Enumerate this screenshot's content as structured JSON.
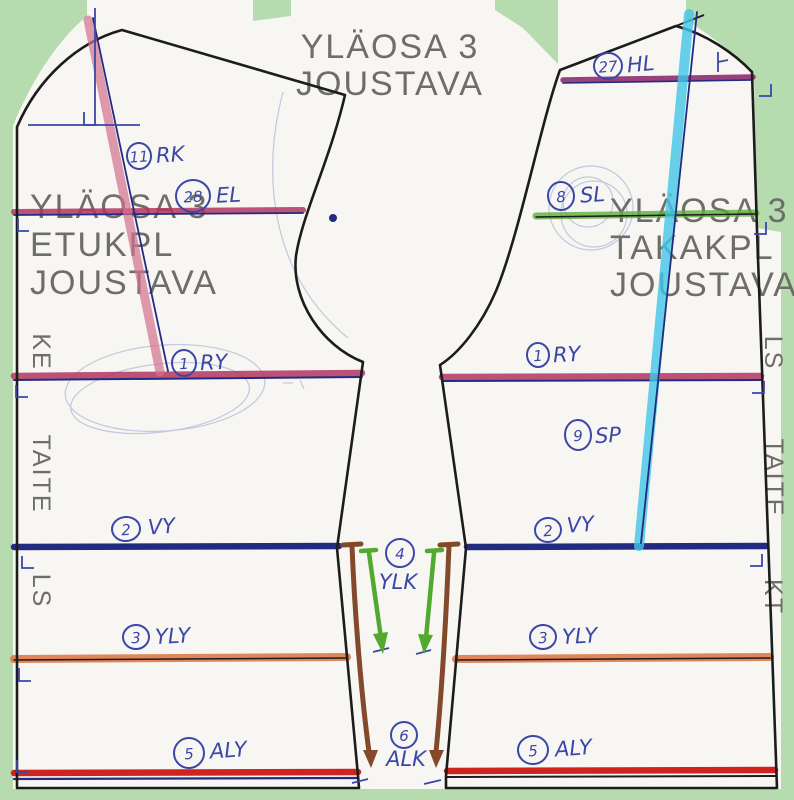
{
  "colors": {
    "background": "#b6dbaf",
    "paper": "#f7f6f2",
    "outline": "#1c1c1c",
    "printed_gray": "#6e6d6a",
    "pen_blue": "#3a47a7",
    "navy": "#232b80",
    "crimson": "#b23560",
    "purple_hl": "#8d2e72",
    "orange": "#dd7340",
    "red": "#cf231f",
    "green_line": "#5fae3e",
    "cyan": "#41c6e8",
    "pink": "#d2718f",
    "brown": "#83492a",
    "arrow_green": "#52a930",
    "pencil": "#98a2cf"
  },
  "header": {
    "title_line1": "YLÄOSA 3",
    "title_line2": "JOUSTAVA"
  },
  "front_piece": {
    "lines": [
      "YLÄOSA 3",
      "ETUKPL",
      "JOUSTAVA"
    ],
    "edge_top": "KE",
    "edge_mid": "TAITE",
    "edge_bottom": "LS"
  },
  "back_piece": {
    "lines": [
      "YLÄOSA 3",
      "TAKAKPL",
      "JOUSTAVA"
    ],
    "edge_top": "LS",
    "edge_mid": "TAITE",
    "edge_bottom": "KT"
  },
  "annotations": {
    "rk": {
      "num": "11",
      "label": "RK"
    },
    "el": {
      "num": "28",
      "label": "EL"
    },
    "ry_front": {
      "num": "1",
      "label": "RY"
    },
    "vy_front": {
      "num": "2",
      "label": "VY"
    },
    "yly_front": {
      "num": "3",
      "label": "YLY"
    },
    "aly_front": {
      "num": "5",
      "label": "ALY"
    },
    "hl": {
      "num": "27",
      "label": "HL"
    },
    "sl": {
      "num": "8",
      "label": "SL"
    },
    "ry_back": {
      "num": "1",
      "label": "RY"
    },
    "sp": {
      "num": "9",
      "label": "SP"
    },
    "vy_back": {
      "num": "2",
      "label": "VY"
    },
    "yly_back": {
      "num": "3",
      "label": "YLY"
    },
    "aly_back": {
      "num": "5",
      "label": "ALY"
    },
    "ylk": {
      "num": "4",
      "label": "YLK"
    },
    "alk": {
      "num": "6",
      "label": "ALK"
    }
  }
}
